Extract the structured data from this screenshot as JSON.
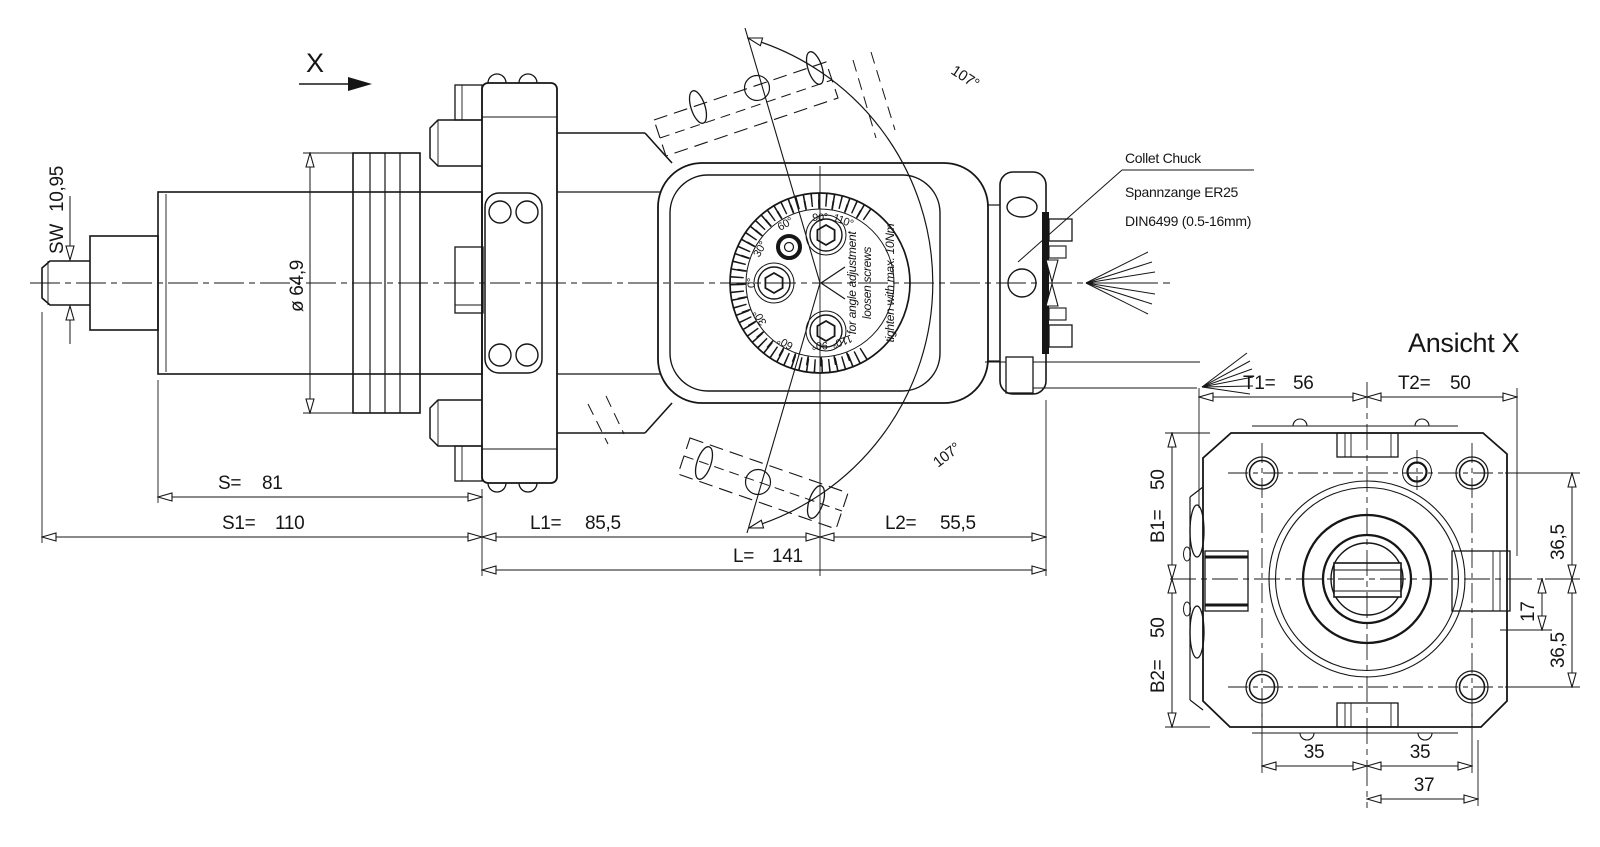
{
  "drawing": {
    "view_arrow": "X",
    "main": {
      "dim_sw_label": "SW",
      "dim_sw_value": "10,95",
      "dim_dia": "ø 64,9",
      "arc_angle_top": "107°",
      "arc_angle_bottom": "107°",
      "collet_line1": "Collet Chuck",
      "collet_line2": "Spannzange ER25",
      "collet_line3": "DIN6499 (0.5-16mm)",
      "dial": {
        "zero": "0°",
        "u30": "30°",
        "u60": "60°",
        "u90": "90°",
        "u110": "110°",
        "l30": "30°",
        "l60": "60°",
        "l90": "90°",
        "l110": "110°",
        "note1": "for angle adjustment",
        "note2": "loosen screws",
        "note3": "tighten with max. 10Nm"
      },
      "dims": {
        "s_label": "S=",
        "s_value": "81",
        "s1_label": "S1=",
        "s1_value": "110",
        "l1_label": "L1=",
        "l1_value": "85,5",
        "l2_label": "L2=",
        "l2_value": "55,5",
        "l_label": "L=",
        "l_value": "141"
      }
    },
    "ansicht": {
      "title": "Ansicht X",
      "t1_label": "T1=",
      "t1_value": "56",
      "t2_label": "T2=",
      "t2_value": "50",
      "b1_label": "B1=",
      "b1_value": "50",
      "b2_label": "B2=",
      "b2_value": "50",
      "right_top": "36,5",
      "right_mid": "17",
      "right_bottom": "36,5",
      "bottom_left": "35",
      "bottom_right": "35",
      "bottom_center": "37"
    }
  }
}
